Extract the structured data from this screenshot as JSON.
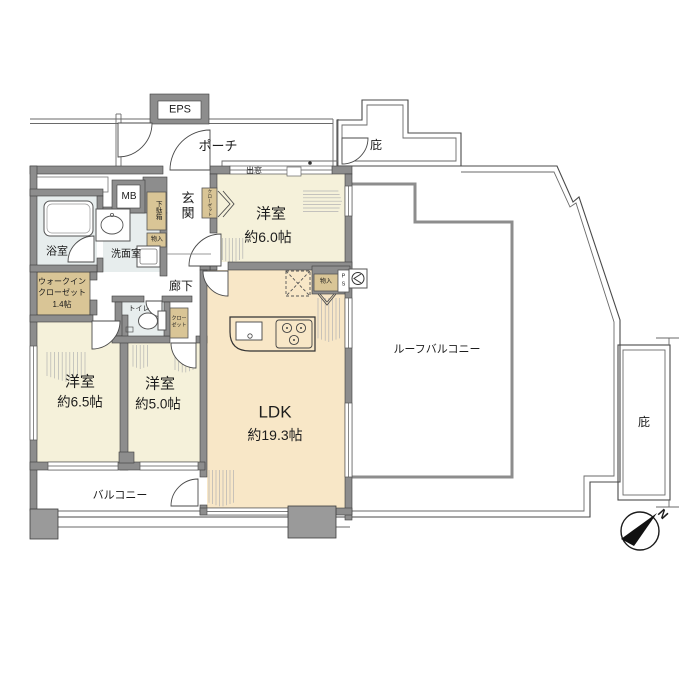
{
  "title": "マンション間取り図 (3LDK + ウォークインクローゼット)",
  "colors": {
    "wall_gray": "#8d8d8d",
    "bedroom_cream": "#f5f1da",
    "ldk_tan": "#f8e7c7",
    "wet_area_blue": "#e7eded",
    "closet_tan": "#d9c596",
    "outline": "#444444"
  },
  "rooms": {
    "eps": "EPS",
    "porch": "ポーチ",
    "canopy_top": "庇",
    "canopy_right": "庇",
    "mb": "MB",
    "entrance": "玄関",
    "shoe_box": "下駄箱",
    "storage_entrance": "物入",
    "bay_window": "出窓",
    "closet_bedroom1": "クローゼット",
    "bathroom": "浴室",
    "washroom": "洗面室",
    "wic_line1": "ウォークイン",
    "wic_line2": "クローゼット",
    "wic_line3": "1.4帖",
    "hallway": "廊下",
    "toilet": "トイレ",
    "closet_small_line1": "クロー",
    "closet_small_line2": "ゼット",
    "bedroom1_name": "洋室",
    "bedroom1_size": "約6.0帖",
    "bedroom2_name": "洋室",
    "bedroom2_size": "約6.5帖",
    "bedroom3_name": "洋室",
    "bedroom3_size": "約5.0帖",
    "ldk_name": "LDK",
    "ldk_size": "約19.3帖",
    "storage_ldk": "物入",
    "ps_line1": "P",
    "ps_line2": "S",
    "roof_balcony": "ルーフバルコニー",
    "balcony": "バルコニー",
    "compass_north": "N"
  }
}
